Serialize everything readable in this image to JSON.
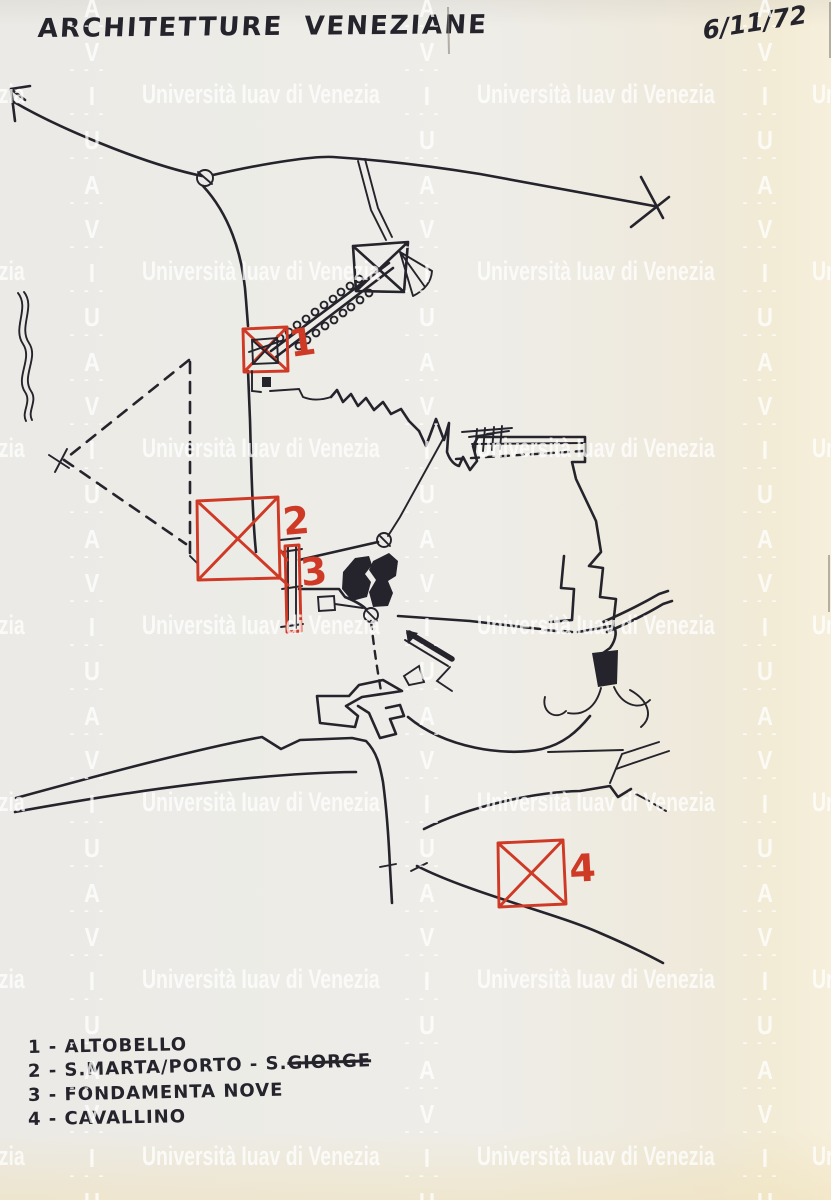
{
  "document": {
    "title": "ARCHITETTURE VENEZIANE",
    "date": "6/11/72"
  },
  "watermark": {
    "text": "Università Iuav di Venezia",
    "letters": [
      "I",
      "U",
      "A",
      "V"
    ],
    "dashes": "- - -"
  },
  "marker_labels": [
    "1",
    "2",
    "3",
    "4"
  ],
  "legend": {
    "items": [
      {
        "text": "1 - ALTOBELLO",
        "strike": ""
      },
      {
        "text": "2 - S.MARTA/PORTO - S.",
        "strike": "GIORGE"
      },
      {
        "text": "3 - FONDAMENTA NOVE",
        "strike": ""
      },
      {
        "text": "4 - CAVALLINO",
        "strike": ""
      }
    ]
  },
  "colors": {
    "ink": "#25232b",
    "red": "#cf3a26",
    "paper": "#edece8",
    "paper-warm": "#f4ecd8",
    "watermark": "rgba(255,255,255,0.75)"
  }
}
